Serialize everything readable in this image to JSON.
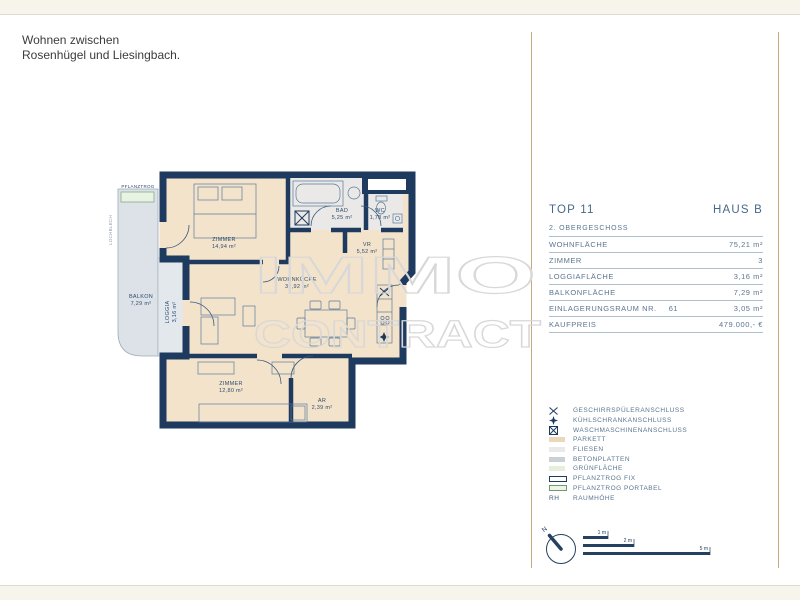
{
  "header": {
    "tagline_line1": "Wohnen zwischen",
    "tagline_line2": "Rosenhügel und Liesingbach."
  },
  "floorplan": {
    "watermark": {
      "line1": "IMMO",
      "line2": "CONTRACT"
    },
    "annotations": {
      "pflanztrog": "PFLANZTROG",
      "lochblech": "LOCHBLECH"
    },
    "rooms": [
      {
        "name": "ZIMMER",
        "area": "14,94 m²"
      },
      {
        "name": "BAD",
        "area": "5,25 m²"
      },
      {
        "name": "WC",
        "area": "1,78 m²"
      },
      {
        "name": "VR",
        "area": "5,52 m²"
      },
      {
        "name": "WOHNKÜCHE",
        "area": "32,92 m²"
      },
      {
        "name": "BALKON",
        "area": "7,29 m²"
      },
      {
        "name": "LOGGIA",
        "area": "3,16 m²"
      },
      {
        "name": "ZIMMER",
        "area": "12,80 m²"
      },
      {
        "name": "AR",
        "area": "2,39 m²"
      }
    ]
  },
  "info_panel": {
    "unit": "TOP 11",
    "building": "HAUS B",
    "floor": "2. OBERGESCHOSS",
    "rows": [
      {
        "label": "WOHNFLÄCHE",
        "label_suffix": "",
        "value": "75,21 m²"
      },
      {
        "label": "ZIMMER",
        "label_suffix": "",
        "value": "3"
      },
      {
        "label": "LOGGIAFLÄCHE",
        "label_suffix": "",
        "value": "3,16 m²"
      },
      {
        "label": "BALKONFLÄCHE",
        "label_suffix": "",
        "value": "7,29 m²"
      },
      {
        "label": "EINLAGERUNGSRAUM NR.",
        "label_suffix": "61",
        "value": "3,05 m²"
      },
      {
        "label": "KAUFPREIS",
        "label_suffix": "",
        "value": "479.000,- €"
      }
    ]
  },
  "legend": {
    "items": [
      {
        "symbol": "dishwasher-cross",
        "label": "GESCHIRRSPÜLERANSCHLUSS"
      },
      {
        "symbol": "fridge-star",
        "label": "KÜHLSCHRANKANSCHLUSS"
      },
      {
        "symbol": "washer-boxed-cross",
        "label": "WASCHMASCHINENANSCHLUSS"
      },
      {
        "symbol": "swatch-parkett",
        "label": "PARKETT"
      },
      {
        "symbol": "swatch-fliesen",
        "label": "FLIESEN"
      },
      {
        "symbol": "swatch-betonplatten",
        "label": "BETONPLATTEN"
      },
      {
        "symbol": "swatch-gruenflaeche",
        "label": "GRÜNFLÄCHE"
      },
      {
        "symbol": "swatch-pflanztrog-fix",
        "label": "PFLANZTROG FIX"
      },
      {
        "symbol": "swatch-pflanztrog-portabel",
        "label": "PFLANZTROG PORTABEL"
      },
      {
        "symbol": "rh-text",
        "symbol_text": "RH",
        "label": "RAUMHÖHE"
      }
    ]
  },
  "scale_bar": {
    "north": "N",
    "ticks": [
      "1 m",
      "2 m",
      "5 m"
    ]
  },
  "colors": {
    "wall_navy": "#1e3a5f",
    "parkett": "#f4e3cb",
    "fliesen": "#eae9e7",
    "balkon": "#dce2e7",
    "gruenflaeche": "#e9f3e3",
    "gold_rule": "#c9a97c",
    "panel_text": "#5b7690",
    "cream_band": "#f7f4ec",
    "watermark": "#d8d8d8"
  }
}
